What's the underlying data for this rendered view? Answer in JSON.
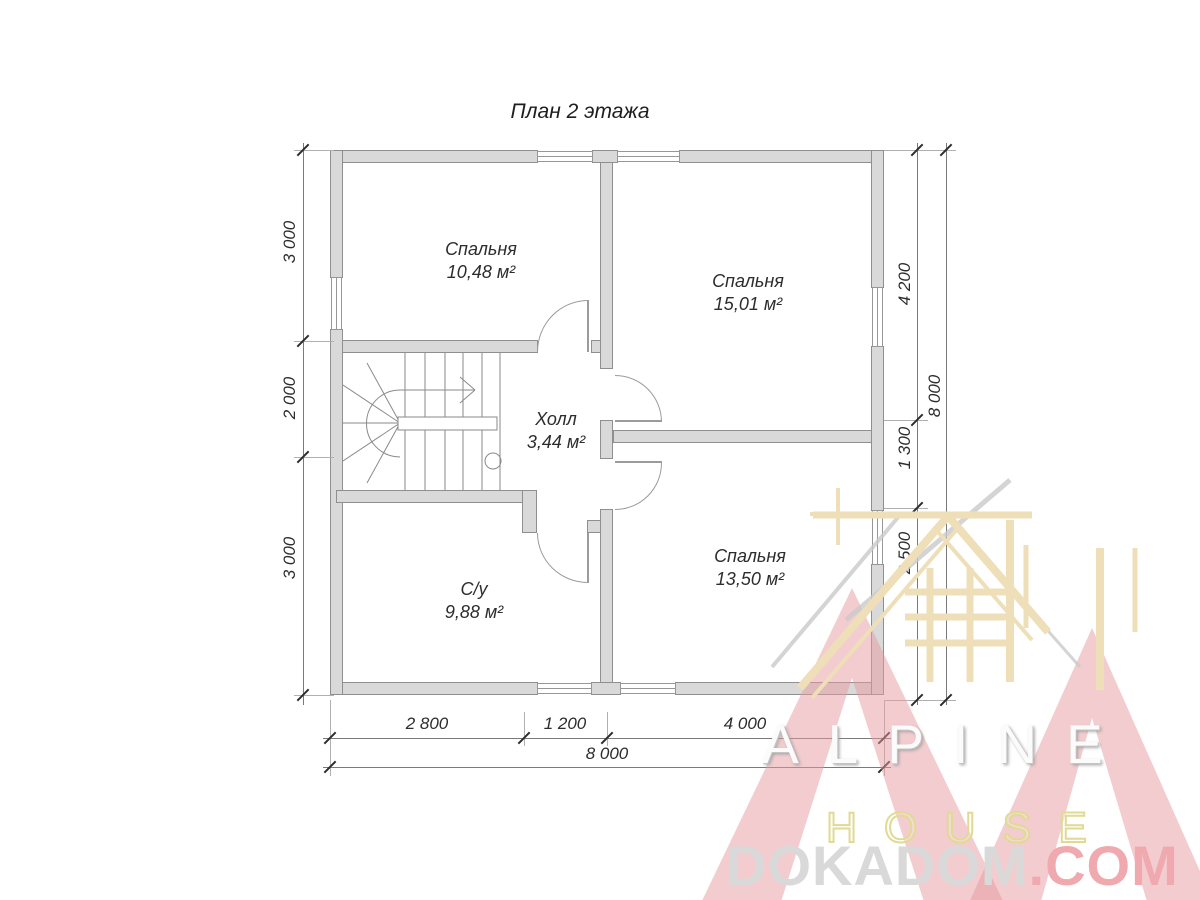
{
  "title": "План 2 этажа",
  "rooms": [
    {
      "name": "Спальня",
      "area": "10,48 м²"
    },
    {
      "name": "Спальня",
      "area": "15,01 м²"
    },
    {
      "name": "Холл",
      "area": "3,44 м²"
    },
    {
      "name": "С/у",
      "area": "9,88 м²"
    },
    {
      "name": "Спальня",
      "area": "13,50 м²"
    }
  ],
  "dimensions": {
    "left": [
      "3 000",
      "2 000",
      "3 000"
    ],
    "right": [
      "4 200",
      "1 300",
      "2 500"
    ],
    "right_total": "8 000",
    "bottom": [
      "2 800",
      "1 200",
      "4 000"
    ],
    "bottom_total": "8 000"
  },
  "watermark": {
    "brand_top": "ALPINE",
    "brand_bottom": "HOUSE",
    "site_name": "DOKADOM",
    "site_tld": ".COM"
  },
  "colors": {
    "wall_fill": "#d9d9d9",
    "wall_line": "#8f8f8f",
    "dim_text": "#2d2d2d",
    "logo_pink": "#eec3c7",
    "logo_beige": "#eedfb8",
    "site_gray": "#d9d9d9",
    "site_red": "#f0a9ae"
  }
}
